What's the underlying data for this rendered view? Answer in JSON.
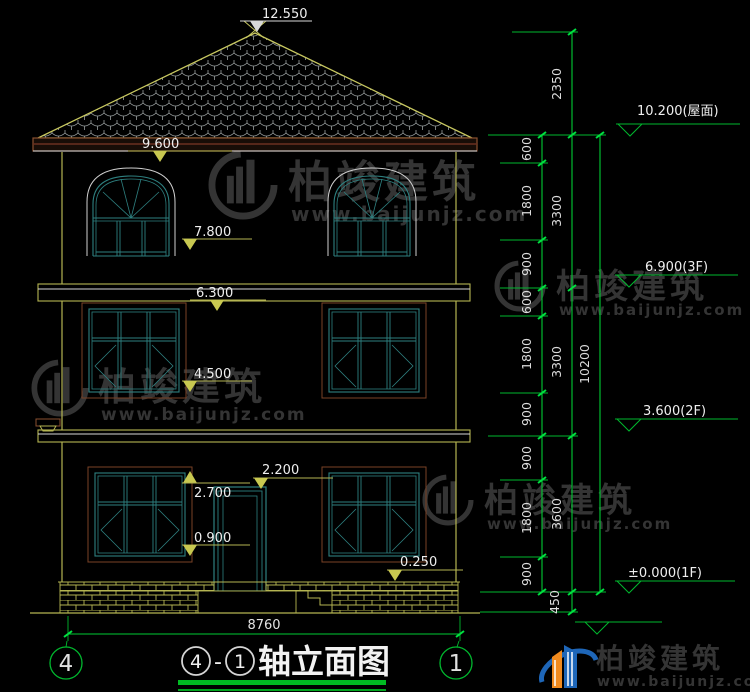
{
  "drawing": {
    "peak_level": "12.550",
    "eave_level": "9.600",
    "f3_sill_level": "7.800",
    "f2_top_level": "6.300",
    "f2_sill_level": "4.500",
    "f1_top_level": "2.700",
    "door_top_level": "2.200",
    "f1_sill_level": "0.900",
    "porch_level": "0.250",
    "total_width": "8760"
  },
  "right_panel": {
    "roof_label": "10.200(屋面)",
    "f3_label": "6.900(3F)",
    "f2_label": "3.600(2F)",
    "f1_label": "±0.000(1F)",
    "chain_inner": [
      "600",
      "1800",
      "900",
      "600",
      "1800",
      "900",
      "900",
      "1800",
      "900"
    ],
    "chain_mid": [
      "2350",
      "3300",
      "3300",
      "3600",
      "450"
    ],
    "chain_outer": [
      "10200"
    ]
  },
  "axes": {
    "left": "4",
    "right": "1"
  },
  "title": {
    "separator": "-",
    "text": "轴立面图"
  },
  "watermark": {
    "brand": "柏竣建筑",
    "url": "www.baijunjz.com"
  },
  "colors": {
    "dimension_green": "#00cc33",
    "cad_yellow": "#b5b552",
    "window_teal": "#2e8080",
    "frame_brown": "#7a4226",
    "text_white": "#e8e8e8",
    "logo_blue": "#1e66b8",
    "logo_orange": "#f08a1e",
    "watermark_gray": "#343434"
  }
}
